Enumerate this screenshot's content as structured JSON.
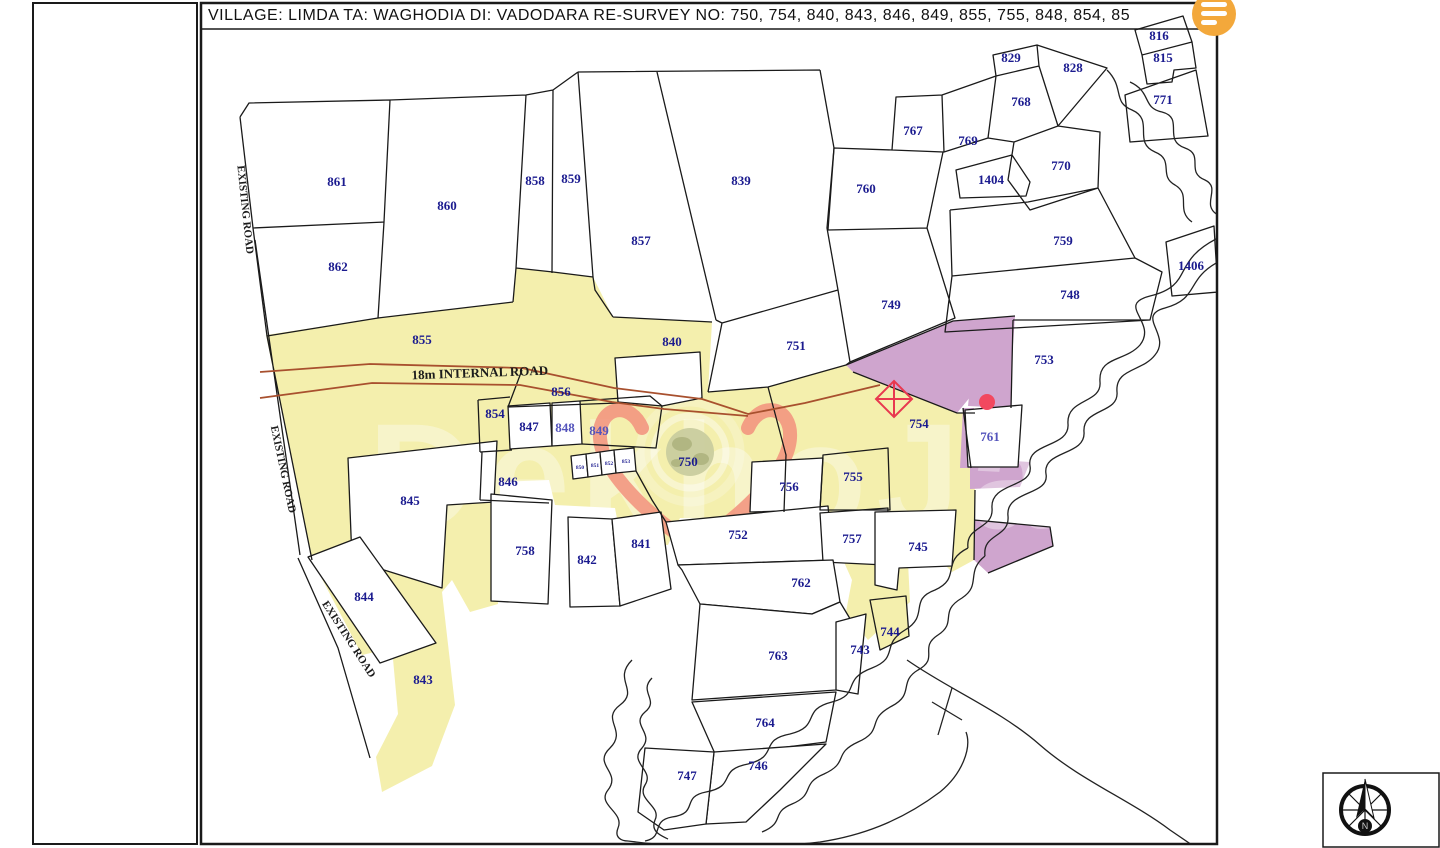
{
  "title": "VILLAGE:  LIMDA  TA: WAGHODIA  DI: VADODARA    RE-SURVEY NO:  750, 754, 840, 843, 846, 849, 855, 755, 848, 854, 85",
  "watermark": {
    "brand": "DekhoJamin",
    "logo": "globe-heart-pin-logo"
  },
  "compass": {
    "label": "N",
    "icon": "compass-north-icon"
  },
  "menu_button": {
    "icon": "hamburger-menu-icon"
  },
  "colors": {
    "parcel_yellow": "#f4efad",
    "parcel_purple": "#cfa5ce",
    "number_navy": "#1b1b8f",
    "number_light": "#5454bc",
    "road_red": "#a8502e",
    "marker_red": "#e8384f",
    "dot_red": "#f2485f",
    "menu_orange": "#f3a83b",
    "heart_salmon": "#f2907c"
  },
  "road_labels": [
    {
      "text": "18m INTERNAL ROAD",
      "x": 480,
      "y": 377,
      "rotate": -2,
      "size": 13
    },
    {
      "text": "EXISTING ROAD",
      "x": 242,
      "y": 210,
      "rotate": 84,
      "size": 11
    },
    {
      "text": "EXISTING ROAD",
      "x": 280,
      "y": 470,
      "rotate": 78,
      "size": 11
    },
    {
      "text": "EXISTING ROAD",
      "x": 346,
      "y": 641,
      "rotate": 57,
      "size": 11
    }
  ],
  "parcels": [
    {
      "n": "861",
      "x": 337,
      "y": 186
    },
    {
      "n": "862",
      "x": 338,
      "y": 271
    },
    {
      "n": "860",
      "x": 447,
      "y": 210
    },
    {
      "n": "858",
      "x": 535,
      "y": 185
    },
    {
      "n": "859",
      "x": 571,
      "y": 183
    },
    {
      "n": "857",
      "x": 641,
      "y": 245
    },
    {
      "n": "839",
      "x": 741,
      "y": 185
    },
    {
      "n": "751",
      "x": 796,
      "y": 350
    },
    {
      "n": "749",
      "x": 891,
      "y": 309
    },
    {
      "n": "760",
      "x": 866,
      "y": 193
    },
    {
      "n": "767",
      "x": 913,
      "y": 135
    },
    {
      "n": "769",
      "x": 968,
      "y": 145
    },
    {
      "n": "829",
      "x": 1011,
      "y": 62
    },
    {
      "n": "828",
      "x": 1073,
      "y": 72
    },
    {
      "n": "768",
      "x": 1021,
      "y": 106
    },
    {
      "n": "816",
      "x": 1159,
      "y": 40
    },
    {
      "n": "815",
      "x": 1163,
      "y": 62
    },
    {
      "n": "771",
      "x": 1163,
      "y": 104
    },
    {
      "n": "770",
      "x": 1061,
      "y": 170
    },
    {
      "n": "1404",
      "x": 991,
      "y": 184
    },
    {
      "n": "759",
      "x": 1063,
      "y": 245
    },
    {
      "n": "748",
      "x": 1070,
      "y": 299
    },
    {
      "n": "1406",
      "x": 1191,
      "y": 270
    },
    {
      "n": "753",
      "x": 1044,
      "y": 364
    },
    {
      "n": "855",
      "x": 422,
      "y": 344
    },
    {
      "n": "840",
      "x": 672,
      "y": 346
    },
    {
      "n": "856",
      "x": 561,
      "y": 396
    },
    {
      "n": "854",
      "x": 495,
      "y": 418
    },
    {
      "n": "847",
      "x": 529,
      "y": 431
    },
    {
      "n": "848",
      "x": 565,
      "y": 432,
      "lt": true
    },
    {
      "n": "849",
      "x": 599,
      "y": 435,
      "lt": true
    },
    {
      "n": "750",
      "x": 688,
      "y": 466
    },
    {
      "n": "754",
      "x": 919,
      "y": 428
    },
    {
      "n": "761",
      "x": 990,
      "y": 441,
      "lt": true
    },
    {
      "n": "846",
      "x": 508,
      "y": 486
    },
    {
      "n": "845",
      "x": 410,
      "y": 505
    },
    {
      "n": "756",
      "x": 789,
      "y": 491
    },
    {
      "n": "755",
      "x": 853,
      "y": 481
    },
    {
      "n": "752",
      "x": 738,
      "y": 539
    },
    {
      "n": "757",
      "x": 852,
      "y": 543
    },
    {
      "n": "745",
      "x": 918,
      "y": 551
    },
    {
      "n": "758",
      "x": 525,
      "y": 555
    },
    {
      "n": "842",
      "x": 587,
      "y": 564
    },
    {
      "n": "841",
      "x": 641,
      "y": 548
    },
    {
      "n": "844",
      "x": 364,
      "y": 601
    },
    {
      "n": "843",
      "x": 423,
      "y": 684
    },
    {
      "n": "762",
      "x": 801,
      "y": 587
    },
    {
      "n": "744",
      "x": 890,
      "y": 636
    },
    {
      "n": "743",
      "x": 860,
      "y": 654
    },
    {
      "n": "763",
      "x": 778,
      "y": 660
    },
    {
      "n": "764",
      "x": 765,
      "y": 727
    },
    {
      "n": "746",
      "x": 758,
      "y": 770
    },
    {
      "n": "747",
      "x": 687,
      "y": 780
    },
    {
      "n": "850",
      "x": 580,
      "y": 469,
      "tiny": true
    },
    {
      "n": "851",
      "x": 595,
      "y": 467,
      "tiny": true
    },
    {
      "n": "852",
      "x": 609,
      "y": 465,
      "tiny": true
    },
    {
      "n": "853",
      "x": 626,
      "y": 463,
      "tiny": true
    }
  ]
}
